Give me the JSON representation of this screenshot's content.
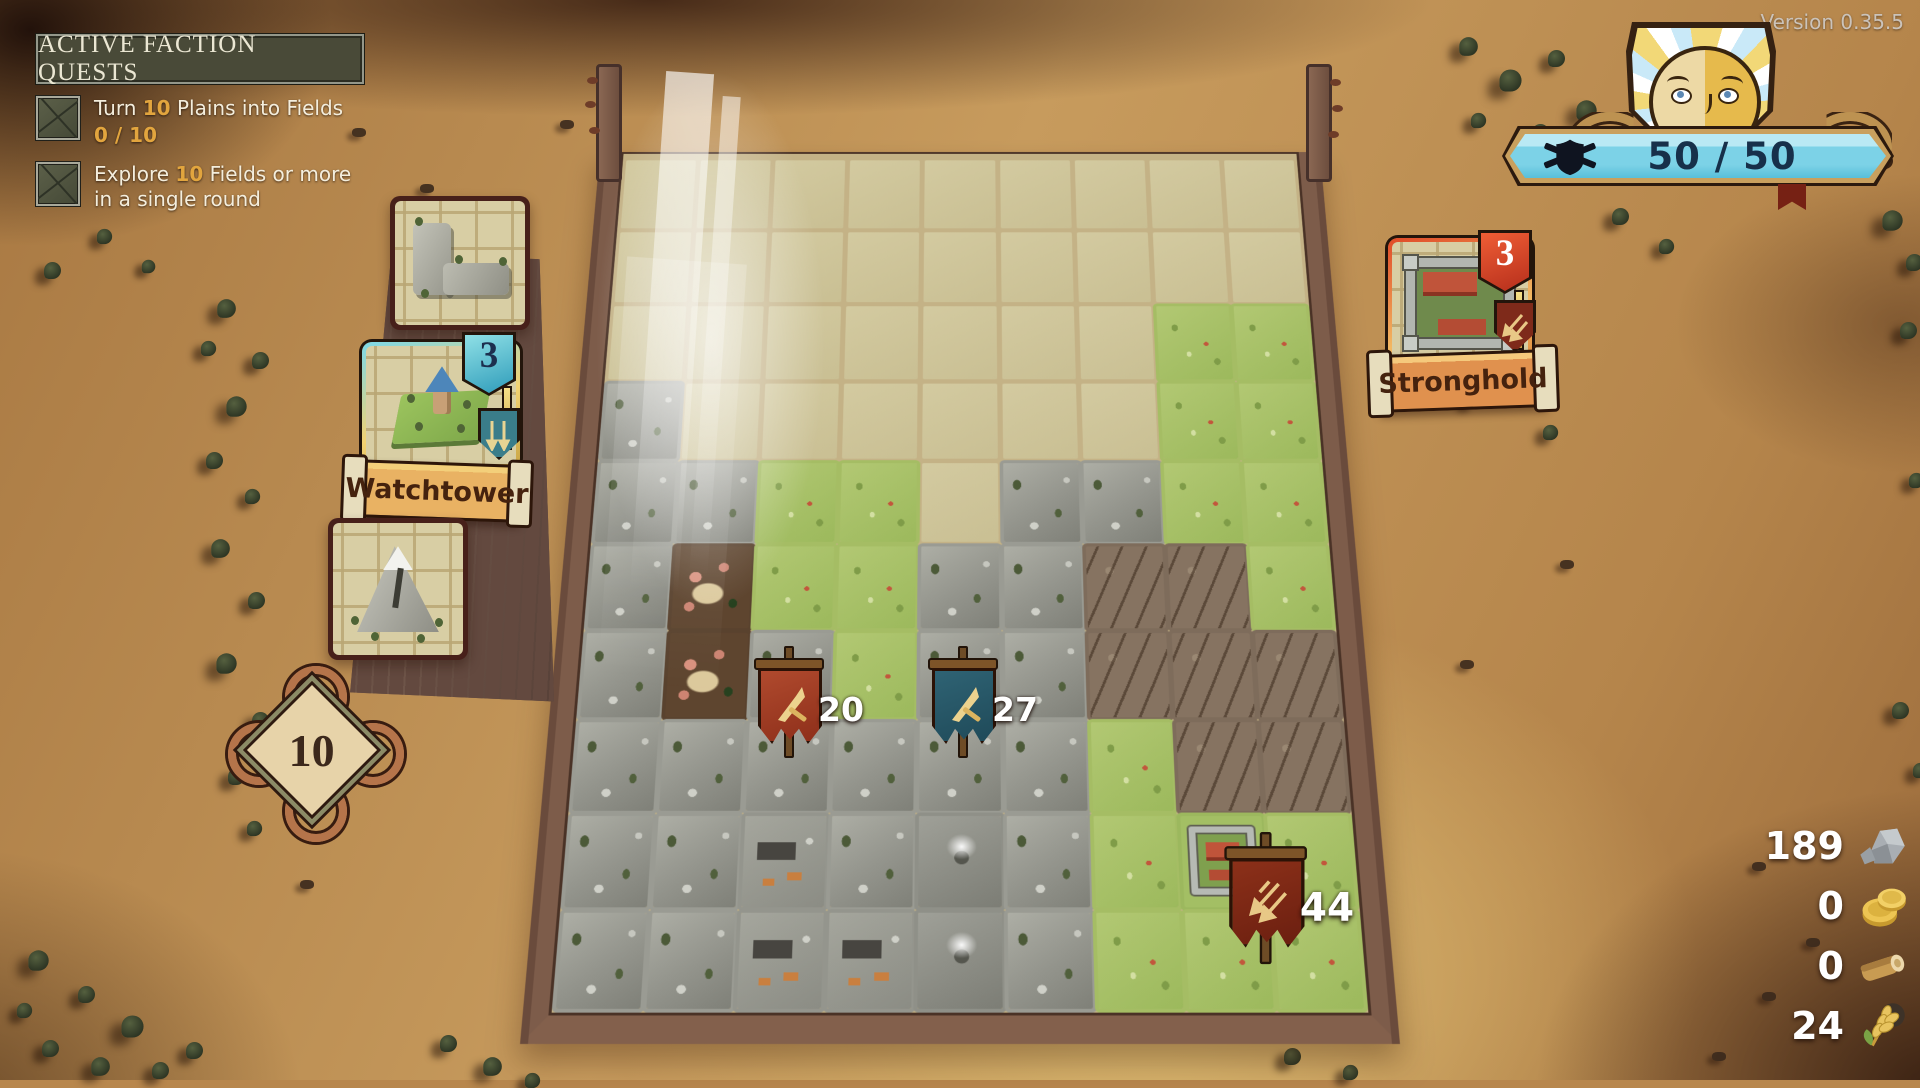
{
  "hud": {
    "version": "Version 0.35.5",
    "morale": {
      "value": "50 / 50",
      "bar_color": "#7cd2e7"
    }
  },
  "quest_panel": {
    "title": "ACTIVE FACTION QUESTS",
    "quests": [
      {
        "pre": "Turn ",
        "num": "10",
        "post": " Plains into Fields",
        "progress": "0 / 10"
      },
      {
        "pre": "Explore ",
        "num": "10",
        "post": " Fields or more in a single round",
        "progress": ""
      }
    ],
    "accent_color": "#e2a53e"
  },
  "side_panel": {
    "next_tile_card": {
      "type": "l-shaped-rock-piece"
    },
    "building_card": {
      "label": "Watchtower",
      "count": "3"
    },
    "terrain_card": {
      "type": "mountain"
    },
    "tiles_remaining": "10"
  },
  "stronghold_card": {
    "label": "Stronghold",
    "count": "3"
  },
  "board": {
    "cols": 9,
    "rows": 10,
    "tile_legend": {
      "U": "unexplored",
      "R": "rock",
      "G": "grass",
      "C": "canyon",
      "D": "camp",
      "V": "village",
      "M": "volcano",
      "F": "fort"
    },
    "map": [
      "UUUUUUUUU",
      "UUUUUUUUU",
      "UUUUUUUGG",
      "RUUUUUUGG",
      "RRGGURRGG",
      "RDGGRRCCG",
      "RDRGRRCCC",
      "RRRRRRGCC",
      "RRVRMRGFG",
      "RRVVMRGGG"
    ],
    "markers": [
      {
        "value": "20",
        "color": "red",
        "emblem": "sword",
        "x": 752,
        "y": 646,
        "size": "normal"
      },
      {
        "value": "27",
        "color": "teal",
        "emblem": "sword",
        "x": 926,
        "y": 646,
        "size": "normal"
      },
      {
        "value": "44",
        "color": "darkred",
        "emblem": "arrows",
        "x": 1222,
        "y": 832,
        "size": "large"
      }
    ]
  },
  "resources": [
    {
      "name": "stone",
      "value": "189"
    },
    {
      "name": "gold",
      "value": "0"
    },
    {
      "name": "wood",
      "value": "0"
    },
    {
      "name": "wheat",
      "value": "24"
    }
  ],
  "background": {
    "trees": [
      {
        "x": 218,
        "y": 300,
        "s": 1.1
      },
      {
        "x": 200,
        "y": 340,
        "s": 0.9
      },
      {
        "x": 252,
        "y": 352,
        "s": 1
      },
      {
        "x": 228,
        "y": 398,
        "s": 1.2
      },
      {
        "x": 206,
        "y": 452,
        "s": 1
      },
      {
        "x": 244,
        "y": 488,
        "s": 0.9
      },
      {
        "x": 212,
        "y": 540,
        "s": 1.1
      },
      {
        "x": 248,
        "y": 592,
        "s": 1
      },
      {
        "x": 218,
        "y": 655,
        "s": 1.2
      },
      {
        "x": 252,
        "y": 712,
        "s": 1
      },
      {
        "x": 228,
        "y": 768,
        "s": 1
      },
      {
        "x": 246,
        "y": 820,
        "s": 0.9
      },
      {
        "x": 30,
        "y": 952,
        "s": 1.2
      },
      {
        "x": 78,
        "y": 986,
        "s": 1
      },
      {
        "x": 124,
        "y": 1018,
        "s": 1.3
      },
      {
        "x": 42,
        "y": 1040,
        "s": 1
      },
      {
        "x": 92,
        "y": 1058,
        "s": 1.1
      },
      {
        "x": 152,
        "y": 1062,
        "s": 1
      },
      {
        "x": 16,
        "y": 1002,
        "s": 0.9
      },
      {
        "x": 186,
        "y": 1042,
        "s": 1
      },
      {
        "x": 440,
        "y": 1035,
        "s": 1
      },
      {
        "x": 484,
        "y": 1058,
        "s": 1.1
      },
      {
        "x": 524,
        "y": 1072,
        "s": 0.9
      },
      {
        "x": 1460,
        "y": 38,
        "s": 1.1
      },
      {
        "x": 1502,
        "y": 72,
        "s": 1.3
      },
      {
        "x": 1548,
        "y": 50,
        "s": 1
      },
      {
        "x": 1578,
        "y": 102,
        "s": 1.2
      },
      {
        "x": 1532,
        "y": 124,
        "s": 1
      },
      {
        "x": 1470,
        "y": 112,
        "s": 0.9
      },
      {
        "x": 1612,
        "y": 208,
        "s": 1
      },
      {
        "x": 1658,
        "y": 238,
        "s": 0.9
      },
      {
        "x": 1884,
        "y": 212,
        "s": 1.2
      },
      {
        "x": 1906,
        "y": 254,
        "s": 1
      },
      {
        "x": 1482,
        "y": 302,
        "s": 0.9
      },
      {
        "x": 1522,
        "y": 352,
        "s": 1
      },
      {
        "x": 1462,
        "y": 392,
        "s": 0.8
      },
      {
        "x": 1542,
        "y": 424,
        "s": 0.9
      },
      {
        "x": 1900,
        "y": 322,
        "s": 1
      },
      {
        "x": 1908,
        "y": 472,
        "s": 0.9
      },
      {
        "x": 1892,
        "y": 702,
        "s": 1
      },
      {
        "x": 1912,
        "y": 762,
        "s": 0.9
      },
      {
        "x": 96,
        "y": 228,
        "s": 0.9
      },
      {
        "x": 44,
        "y": 262,
        "s": 1
      },
      {
        "x": 140,
        "y": 258,
        "s": 0.8
      },
      {
        "x": 1284,
        "y": 1048,
        "s": 1
      },
      {
        "x": 1342,
        "y": 1064,
        "s": 0.9
      }
    ],
    "debris": [
      {
        "x": 352,
        "y": 128
      },
      {
        "x": 420,
        "y": 184
      },
      {
        "x": 1752,
        "y": 862
      },
      {
        "x": 1806,
        "y": 938
      },
      {
        "x": 1762,
        "y": 992
      },
      {
        "x": 1712,
        "y": 1052
      },
      {
        "x": 560,
        "y": 120
      },
      {
        "x": 1560,
        "y": 560
      },
      {
        "x": 300,
        "y": 880
      },
      {
        "x": 1460,
        "y": 660
      }
    ]
  }
}
